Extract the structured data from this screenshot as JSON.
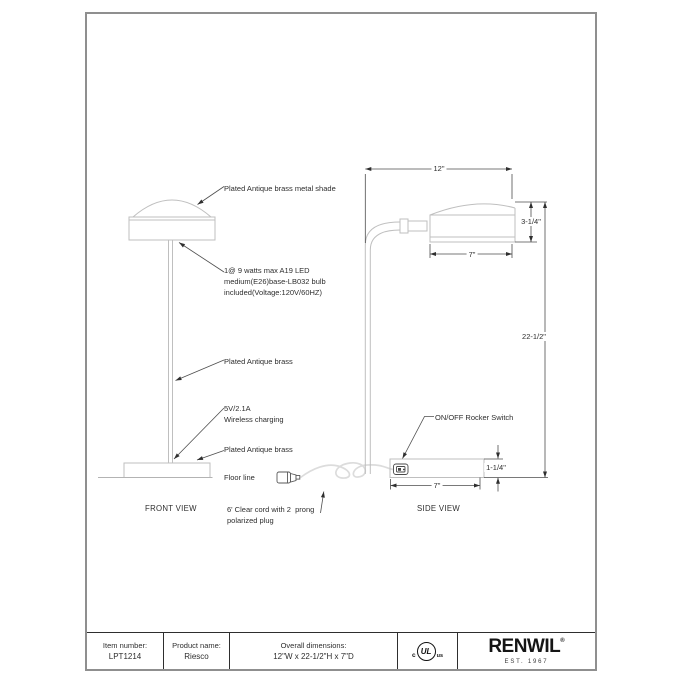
{
  "front_view": {
    "title": "FRONT VIEW",
    "shade_label": "Plated Antique brass metal shade",
    "bulb_label": "1@ 9 watts max A19 LED\nmedium(E26)base-LB032 bulb\nincluded(Voltage:120V/60HZ)",
    "stem_label": "Plated Antique brass",
    "charging_label": "5V/2.1A\nWireless charging",
    "base_label": "Plated Antique brass",
    "floor_label": "Floor line",
    "cord_label": "6' Clear cord with 2  prong\npolarized plug"
  },
  "side_view": {
    "title": "SIDE VIEW",
    "switch_label": "ON/OFF Rocker Switch",
    "dims": {
      "overall_width": "12\"",
      "shade_height": "3-1/4\"",
      "shade_depth": "7\"",
      "overall_height": "22-1/2\"",
      "base_height": "1-1/4\"",
      "base_depth": "7\""
    }
  },
  "footer": {
    "item_number_label": "Item number:",
    "item_number_value": "LPT1214",
    "product_name_label": "Product name:",
    "product_name_value": "Riesco",
    "overall_dimensions_label": "Overall dimensions:",
    "overall_dimensions_value": "12\"W x 22-1/2\"H x 7\"D",
    "ul_mark": {
      "c": "c",
      "ul": "UL",
      "us": "us"
    },
    "brand": {
      "name": "RENWIL",
      "registered": "®",
      "est": "EST. 1967"
    }
  },
  "colors": {
    "page_border": "#8f8f8f",
    "drawing_light": "#bfbfbf",
    "drawing_dark": "#4d4d4d",
    "text": "#2e2e2e",
    "cord": "#dcdcdc"
  }
}
